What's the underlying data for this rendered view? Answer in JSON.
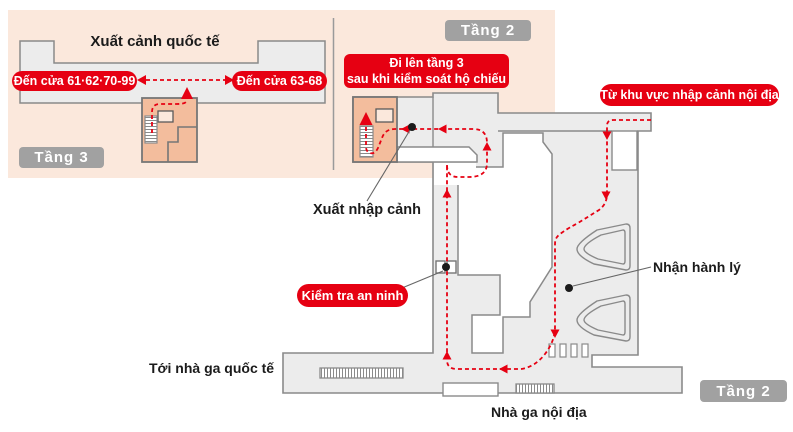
{
  "colors": {
    "accent_red": "#e60012",
    "panel_pink": "#fbe8dc",
    "room_orange": "#f3bd9d",
    "floor_grey": "#ececec",
    "outline_grey": "#8a8a8a",
    "badge_grey": "#a1a1a1",
    "text_black": "#1b1b1b"
  },
  "floor3_inset": {
    "floor_badge": "Tầng 3",
    "title": "Xuất cảnh quốc tế",
    "gate_left_label": "Đến cửa 61·62·70-99",
    "gate_right_label": "Đến cửa 63-68"
  },
  "floor2_inset": {
    "floor_badge": "Tầng 2",
    "instruction_line1": "Đi lên tầng 3",
    "instruction_line2": "sau khi kiểm soát hộ chiếu"
  },
  "main_floor": {
    "from_domestic_label": "Từ khu vực nhập cảnh nội địa",
    "immigration_label": "Xuất nhập cảnh",
    "security_label": "Kiểm tra an ninh",
    "baggage_label": "Nhận hành lý",
    "to_international_label": "Tới nhà ga quốc tế",
    "domestic_terminal_label": "Nhà ga nội địa",
    "floor_badge": "Tầng 2"
  }
}
